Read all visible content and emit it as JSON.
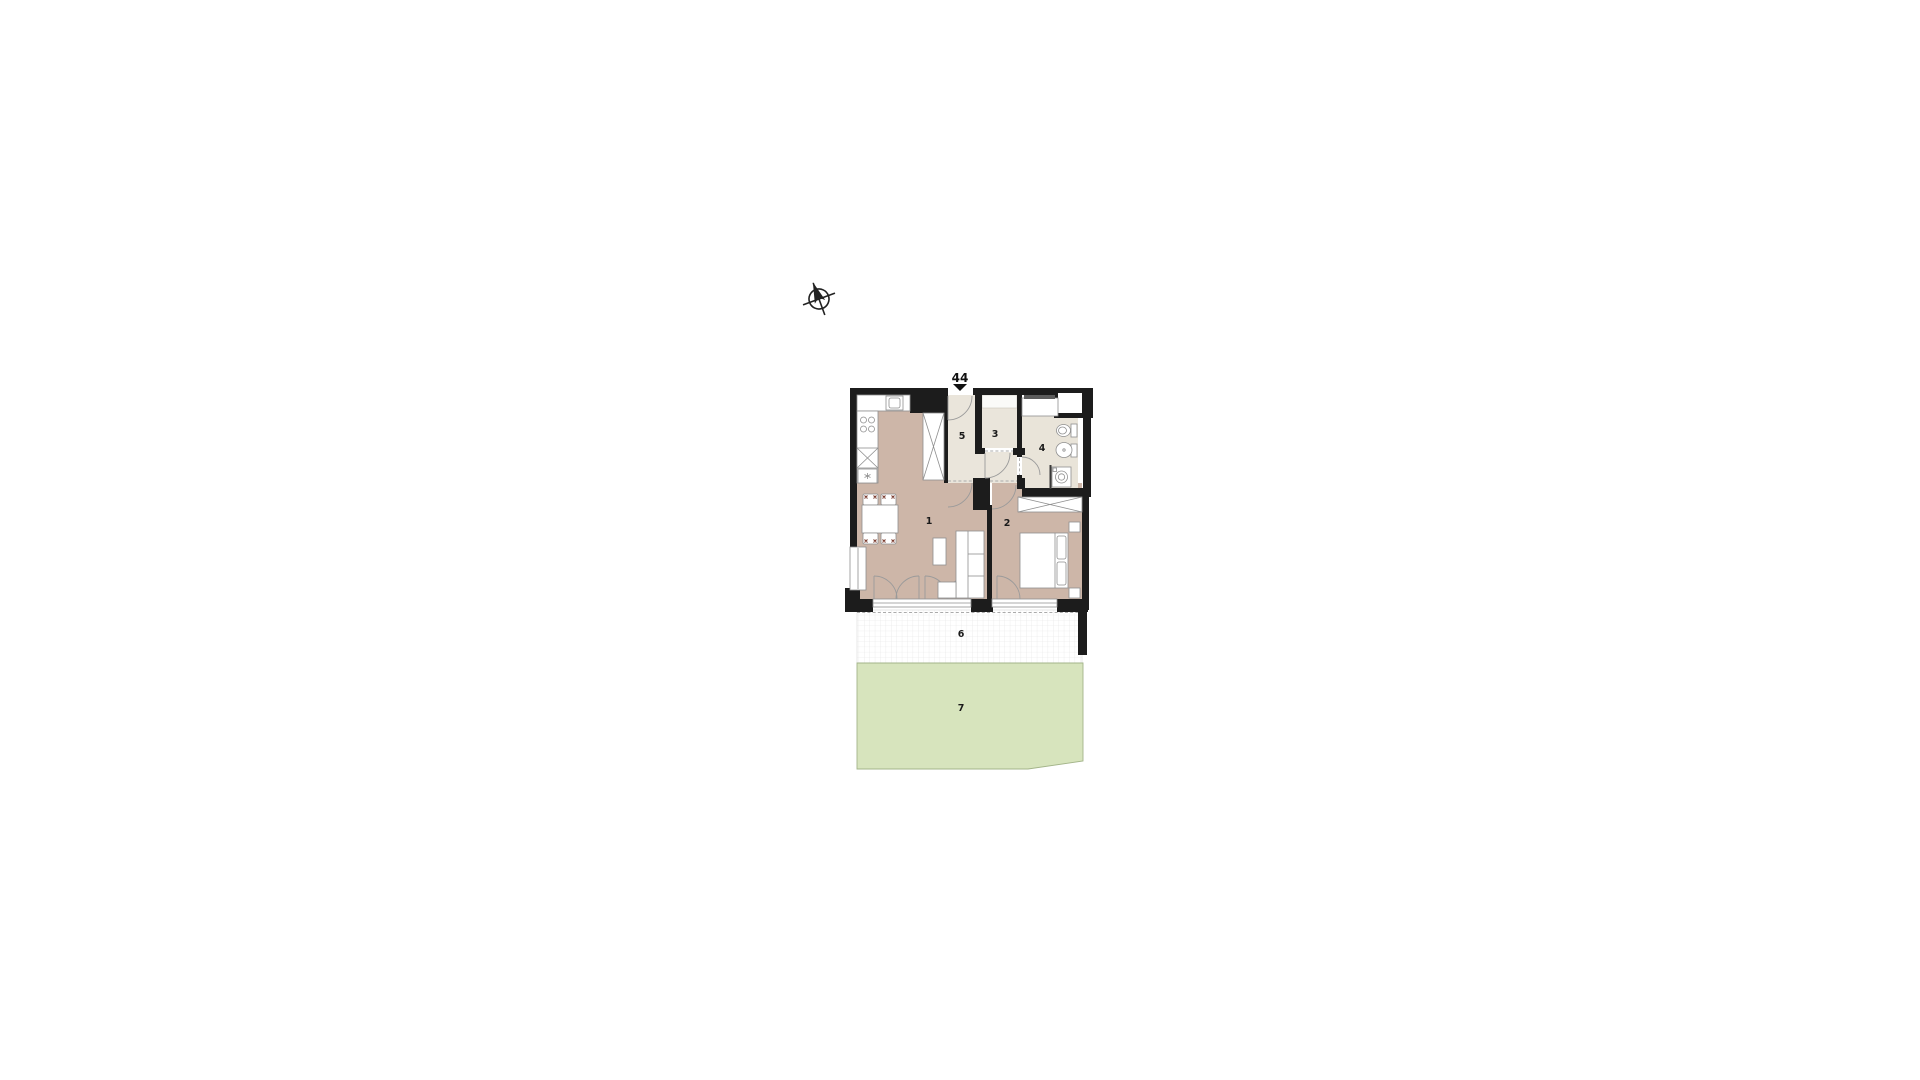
{
  "plan": {
    "title": "apartment-floor-plan",
    "labels": {
      "unit": "44",
      "room1": "1",
      "room2": "2",
      "room3": "3",
      "room4": "4",
      "room5": "5",
      "room6": "6",
      "room7": "7"
    },
    "colors": {
      "wall": "#1c1c1c",
      "floor_tan": "#cdb6a8",
      "floor_light": "#eae5db",
      "bath_floor": "#e9e4d9",
      "terrace_tile_line": "#e3e3e3",
      "garden_fill": "#d7e4bd",
      "garden_border": "#a3b489",
      "furniture_outline": "#8f8f8f",
      "chair_accent": "#7a3b2e"
    }
  }
}
